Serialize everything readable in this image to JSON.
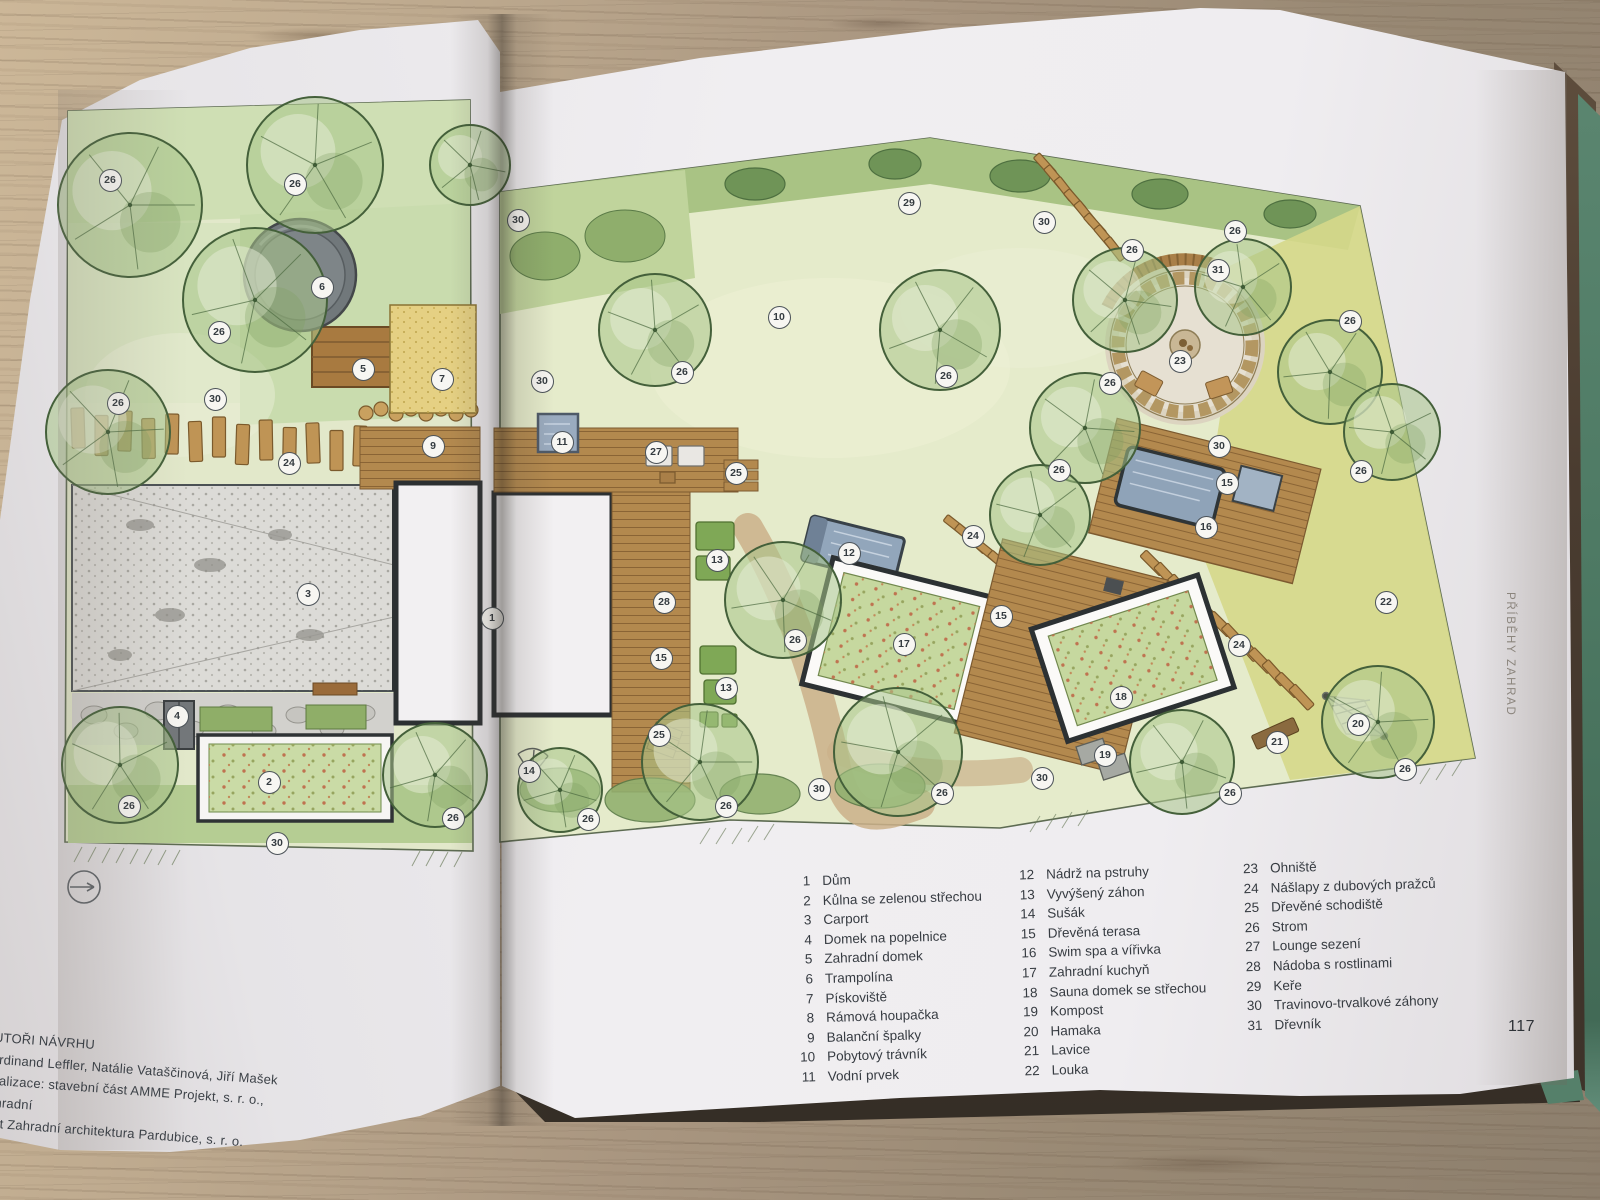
{
  "book": {
    "page_number": "117",
    "edge_label": "PŘÍBĚHY ZAHRAD",
    "credits": {
      "heading": "AUTOŘI NÁVRHU",
      "lines": [
        "Ferdinand Leffler, Natálie Vataščinová, Jiří Mašek",
        "Realizace: stavební část AMME Projekt, s. r. o., zahradní",
        "část Zahradní architektura Pardubice, s. r. o."
      ]
    },
    "legend": {
      "columns": [
        [
          {
            "n": "1",
            "label": "Dům"
          },
          {
            "n": "2",
            "label": "Kůlna se zelenou střechou"
          },
          {
            "n": "3",
            "label": "Carport"
          },
          {
            "n": "4",
            "label": "Domek na popelnice"
          },
          {
            "n": "5",
            "label": "Zahradní domek"
          },
          {
            "n": "6",
            "label": "Trampolína"
          },
          {
            "n": "7",
            "label": "Pískoviště"
          },
          {
            "n": "8",
            "label": "Rámová houpačka"
          },
          {
            "n": "9",
            "label": "Balanční špalky"
          },
          {
            "n": "10",
            "label": "Pobytový trávník"
          },
          {
            "n": "11",
            "label": "Vodní prvek"
          }
        ],
        [
          {
            "n": "12",
            "label": "Nádrž na pstruhy"
          },
          {
            "n": "13",
            "label": "Vyvýšený záhon"
          },
          {
            "n": "14",
            "label": "Sušák"
          },
          {
            "n": "15",
            "label": "Dřevěná terasa"
          },
          {
            "n": "16",
            "label": "Swim spa a vířivka"
          },
          {
            "n": "17",
            "label": "Zahradní kuchyň"
          },
          {
            "n": "18",
            "label": "Sauna domek se střechou"
          },
          {
            "n": "19",
            "label": "Kompost"
          },
          {
            "n": "20",
            "label": "Hamaka"
          },
          {
            "n": "21",
            "label": "Lavice"
          },
          {
            "n": "22",
            "label": "Louka"
          }
        ],
        [
          {
            "n": "23",
            "label": "Ohniště"
          },
          {
            "n": "24",
            "label": "Nášlapy z dubových pražců"
          },
          {
            "n": "25",
            "label": "Dřevěné schodiště"
          },
          {
            "n": "26",
            "label": "Strom"
          },
          {
            "n": "27",
            "label": "Lounge sezení"
          },
          {
            "n": "28",
            "label": "Nádoba s rostlinami"
          },
          {
            "n": "29",
            "label": "Keře"
          },
          {
            "n": "30",
            "label": "Travinovo-trvalkové záhony"
          },
          {
            "n": "31",
            "label": "Dřevník"
          }
        ]
      ]
    }
  },
  "plan": {
    "north_arrow": true,
    "markers": [
      {
        "n": "26",
        "x": 110,
        "y": 180
      },
      {
        "n": "26",
        "x": 295,
        "y": 184
      },
      {
        "n": "6",
        "x": 322,
        "y": 287
      },
      {
        "n": "26",
        "x": 219,
        "y": 332
      },
      {
        "n": "5",
        "x": 363,
        "y": 369
      },
      {
        "n": "7",
        "x": 442,
        "y": 379
      },
      {
        "n": "30",
        "x": 215,
        "y": 399
      },
      {
        "n": "26",
        "x": 118,
        "y": 403
      },
      {
        "n": "9",
        "x": 433,
        "y": 446
      },
      {
        "n": "24",
        "x": 289,
        "y": 463
      },
      {
        "n": "3",
        "x": 308,
        "y": 594
      },
      {
        "n": "4",
        "x": 177,
        "y": 716
      },
      {
        "n": "2",
        "x": 269,
        "y": 782
      },
      {
        "n": "26",
        "x": 129,
        "y": 806
      },
      {
        "n": "26",
        "x": 453,
        "y": 818
      },
      {
        "n": "30",
        "x": 277,
        "y": 843
      },
      {
        "n": "1",
        "x": 492,
        "y": 618
      },
      {
        "n": "30",
        "x": 518,
        "y": 220
      },
      {
        "n": "29",
        "x": 909,
        "y": 203
      },
      {
        "n": "10",
        "x": 779,
        "y": 317
      },
      {
        "n": "26",
        "x": 682,
        "y": 372
      },
      {
        "n": "30",
        "x": 542,
        "y": 381
      },
      {
        "n": "26",
        "x": 946,
        "y": 376
      },
      {
        "n": "11",
        "x": 562,
        "y": 442
      },
      {
        "n": "27",
        "x": 656,
        "y": 452
      },
      {
        "n": "25",
        "x": 736,
        "y": 473
      },
      {
        "n": "30",
        "x": 1044,
        "y": 222
      },
      {
        "n": "26",
        "x": 1132,
        "y": 250
      },
      {
        "n": "26",
        "x": 1235,
        "y": 231
      },
      {
        "n": "31",
        "x": 1218,
        "y": 270
      },
      {
        "n": "26",
        "x": 1350,
        "y": 321
      },
      {
        "n": "23",
        "x": 1180,
        "y": 361
      },
      {
        "n": "26",
        "x": 1110,
        "y": 383
      },
      {
        "n": "30",
        "x": 1219,
        "y": 446
      },
      {
        "n": "26",
        "x": 1059,
        "y": 470
      },
      {
        "n": "26",
        "x": 1361,
        "y": 471
      },
      {
        "n": "15",
        "x": 1227,
        "y": 483
      },
      {
        "n": "16",
        "x": 1206,
        "y": 527
      },
      {
        "n": "24",
        "x": 973,
        "y": 536
      },
      {
        "n": "13",
        "x": 717,
        "y": 560
      },
      {
        "n": "12",
        "x": 849,
        "y": 553
      },
      {
        "n": "28",
        "x": 664,
        "y": 602
      },
      {
        "n": "26",
        "x": 795,
        "y": 640
      },
      {
        "n": "17",
        "x": 904,
        "y": 644
      },
      {
        "n": "15",
        "x": 1001,
        "y": 616
      },
      {
        "n": "15",
        "x": 661,
        "y": 658
      },
      {
        "n": "13",
        "x": 726,
        "y": 688
      },
      {
        "n": "25",
        "x": 659,
        "y": 735
      },
      {
        "n": "26",
        "x": 726,
        "y": 806
      },
      {
        "n": "30",
        "x": 819,
        "y": 789
      },
      {
        "n": "26",
        "x": 942,
        "y": 793
      },
      {
        "n": "30",
        "x": 1042,
        "y": 778
      },
      {
        "n": "22",
        "x": 1386,
        "y": 602
      },
      {
        "n": "24",
        "x": 1239,
        "y": 645
      },
      {
        "n": "18",
        "x": 1121,
        "y": 697
      },
      {
        "n": "19",
        "x": 1105,
        "y": 755
      },
      {
        "n": "21",
        "x": 1277,
        "y": 742
      },
      {
        "n": "20",
        "x": 1358,
        "y": 724
      },
      {
        "n": "26",
        "x": 1405,
        "y": 769
      },
      {
        "n": "26",
        "x": 1230,
        "y": 793
      },
      {
        "n": "14",
        "x": 529,
        "y": 771
      },
      {
        "n": "26",
        "x": 588,
        "y": 819
      }
    ],
    "trees": [
      {
        "x": 130,
        "y": 205,
        "r": 72
      },
      {
        "x": 315,
        "y": 165,
        "r": 68
      },
      {
        "x": 255,
        "y": 300,
        "r": 72
      },
      {
        "x": 108,
        "y": 432,
        "r": 62
      },
      {
        "x": 120,
        "y": 765,
        "r": 58
      },
      {
        "x": 435,
        "y": 775,
        "r": 52
      },
      {
        "x": 470,
        "y": 165,
        "r": 40
      },
      {
        "x": 655,
        "y": 330,
        "r": 56
      },
      {
        "x": 940,
        "y": 330,
        "r": 60
      },
      {
        "x": 1125,
        "y": 300,
        "r": 52
      },
      {
        "x": 1243,
        "y": 287,
        "r": 48
      },
      {
        "x": 1330,
        "y": 372,
        "r": 52
      },
      {
        "x": 1085,
        "y": 428,
        "r": 55
      },
      {
        "x": 1040,
        "y": 515,
        "r": 50
      },
      {
        "x": 783,
        "y": 600,
        "r": 58
      },
      {
        "x": 700,
        "y": 762,
        "r": 58
      },
      {
        "x": 898,
        "y": 752,
        "r": 64
      },
      {
        "x": 1182,
        "y": 762,
        "r": 52
      },
      {
        "x": 1378,
        "y": 722,
        "r": 56
      },
      {
        "x": 1392,
        "y": 432,
        "r": 48
      },
      {
        "x": 560,
        "y": 790,
        "r": 42
      }
    ]
  },
  "palette": {
    "cover_green": "#4e7a64",
    "table_wood": "#a6937c",
    "page": "#efedf0",
    "plan_green_wash": "#d8e4c0",
    "tree_green": "#a8c489",
    "wood_deck": "#b3894e",
    "water_blue": "#90a4b9",
    "meadow_yellow": "#d5d88a",
    "marker_ring": "#4b5258"
  }
}
